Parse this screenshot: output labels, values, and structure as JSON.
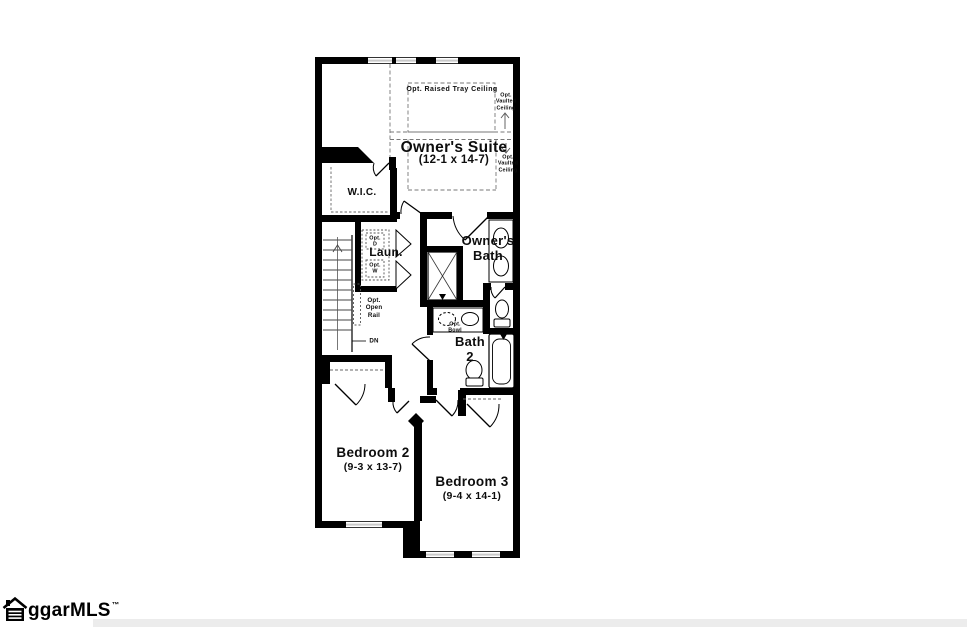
{
  "colors": {
    "ink": "#000000",
    "paper": "#ffffff",
    "strip": "#ececec"
  },
  "plan": {
    "rooms": {
      "owners_suite": {
        "name": "Owner's Suite",
        "dims": "(12-1 x 14-7)"
      },
      "wic": {
        "name": "W.I.C."
      },
      "laundry": {
        "name": "Laun."
      },
      "owners_bath": {
        "name": "Owner's\nBath"
      },
      "bath2": {
        "name": "Bath\n2"
      },
      "bedroom2": {
        "name": "Bedroom 2",
        "dims": "(9-3 x 13-7)"
      },
      "bedroom3": {
        "name": "Bedroom 3",
        "dims": "(9-4 x 14-1)"
      }
    },
    "annotations": {
      "tray_ceiling": "Opt. Raised Tray Ceiling",
      "vaulted_ceiling_upper": "Opt.\nVaulted\nCeiling",
      "vaulted_ceiling_lower": "Opt.\nVaulted\nCeiling",
      "open_rail": "Opt.\nOpen\nRail",
      "down": "DN",
      "opt_dryer": "Opt.\nD",
      "opt_washer": "Opt.\nW",
      "opt_bowl": "Opt.\nBowl"
    }
  },
  "branding": {
    "logo_text": "ggarMLS",
    "trademark": "™"
  }
}
